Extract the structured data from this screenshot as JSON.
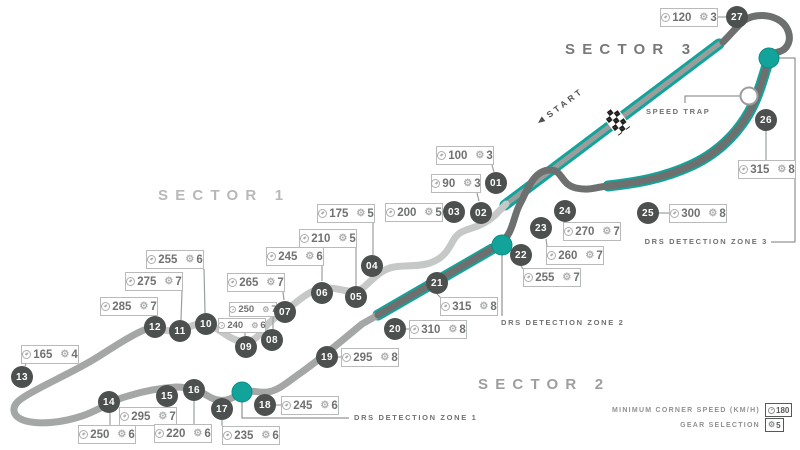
{
  "sectors": [
    {
      "label": "SECTOR 1"
    },
    {
      "label": "SECTOR 2"
    },
    {
      "label": "SECTOR 3"
    }
  ],
  "start_label": "START",
  "speed_trap_label": "SPEED TRAP",
  "drs_zones": [
    {
      "label": "DRS DETECTION ZONE 1"
    },
    {
      "label": "DRS DETECTION ZONE 2"
    },
    {
      "label": "DRS DETECTION ZONE 3"
    }
  ],
  "legend": {
    "speed_label": "MINIMUM CORNER SPEED (KM/H)",
    "speed_value": "180",
    "gear_label": "GEAR SELECTION",
    "gear_value": "5"
  },
  "icons": {
    "speed": "speedometer-icon",
    "gear": "gear-icon",
    "start_arrow": "left-triangle-icon",
    "finish": "checkered-flag-icon"
  },
  "colors": {
    "teal": "#12a49a",
    "light": "#c6c8c7",
    "medium": "#a4a7a6",
    "dark": "#6d706f",
    "straight": "#9a9d9c",
    "marker": "#4c504f"
  },
  "corners": [
    {
      "n": "01",
      "speed": "100",
      "gear": "3"
    },
    {
      "n": "02",
      "speed": "90",
      "gear": "3"
    },
    {
      "n": "03",
      "speed": "200",
      "gear": "5"
    },
    {
      "n": "04",
      "speed": "175",
      "gear": "5"
    },
    {
      "n": "05",
      "speed": "210",
      "gear": "5"
    },
    {
      "n": "06",
      "speed": "245",
      "gear": "6"
    },
    {
      "n": "07",
      "speed": "265",
      "gear": "7"
    },
    {
      "n": "08",
      "speed": "250",
      "gear": "7"
    },
    {
      "n": "09",
      "speed": "240",
      "gear": "6"
    },
    {
      "n": "10",
      "speed": "255",
      "gear": "6"
    },
    {
      "n": "11",
      "speed": "275",
      "gear": "7"
    },
    {
      "n": "12",
      "speed": "285",
      "gear": "7"
    },
    {
      "n": "13",
      "speed": "165",
      "gear": "4"
    },
    {
      "n": "14",
      "speed": "250",
      "gear": "6"
    },
    {
      "n": "15",
      "speed": "295",
      "gear": "7"
    },
    {
      "n": "16",
      "speed": "220",
      "gear": "6"
    },
    {
      "n": "17",
      "speed": "235",
      "gear": "6"
    },
    {
      "n": "18",
      "speed": "245",
      "gear": "6"
    },
    {
      "n": "19",
      "speed": "295",
      "gear": "8"
    },
    {
      "n": "20",
      "speed": "310",
      "gear": "8"
    },
    {
      "n": "21",
      "speed": "315",
      "gear": "8"
    },
    {
      "n": "22",
      "speed": "255",
      "gear": "7"
    },
    {
      "n": "23",
      "speed": "260",
      "gear": "7"
    },
    {
      "n": "24",
      "speed": "270",
      "gear": "7"
    },
    {
      "n": "25",
      "speed": "300",
      "gear": "8"
    },
    {
      "n": "26",
      "speed": "315",
      "gear": "8"
    },
    {
      "n": "27",
      "speed": "120",
      "gear": "3"
    }
  ]
}
